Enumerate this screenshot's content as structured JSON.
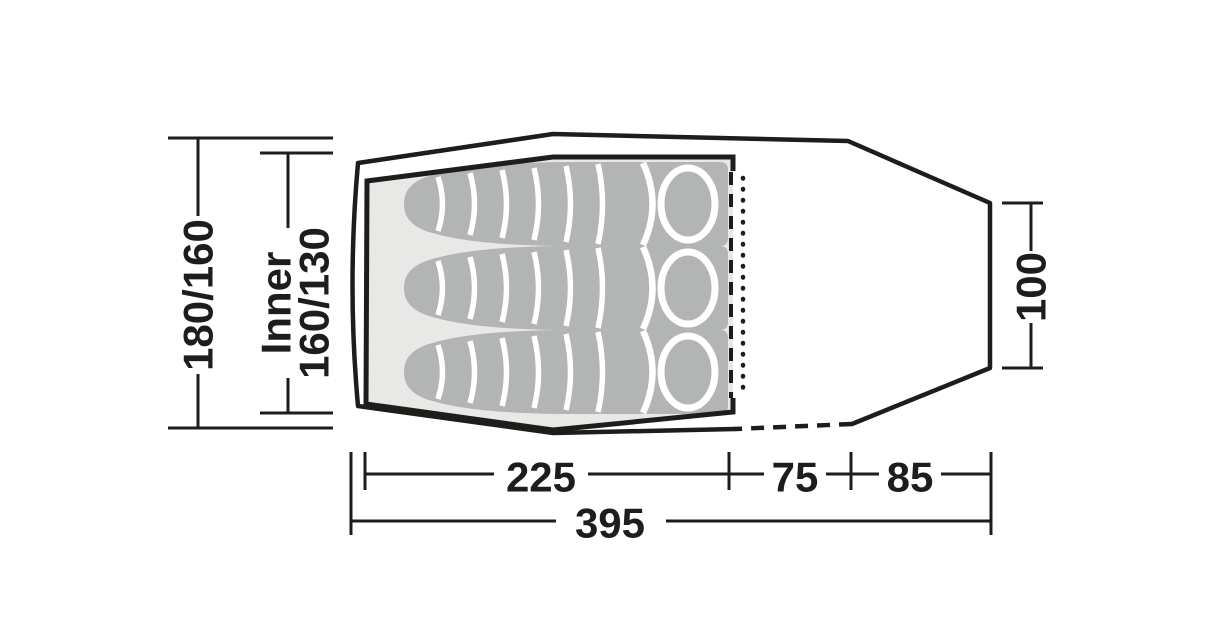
{
  "diagram": {
    "title": "Tent floor plan top view with three sleeping bags",
    "dimensions": {
      "outer_width": "180/160",
      "inner_width_label": "Inner",
      "inner_width": "160/130",
      "rear_width": "100",
      "inner_length": "225",
      "porch_length": "75",
      "rear_length": "85",
      "total_length": "395"
    },
    "sleeping_bags_count": "3",
    "colors": {
      "line": "#1d1d1b",
      "inner_fill": "#e8e8e7",
      "sleeping_bag_fill": "#b3b5b4",
      "seam": "#ffffff",
      "background": "#ffffff"
    }
  }
}
